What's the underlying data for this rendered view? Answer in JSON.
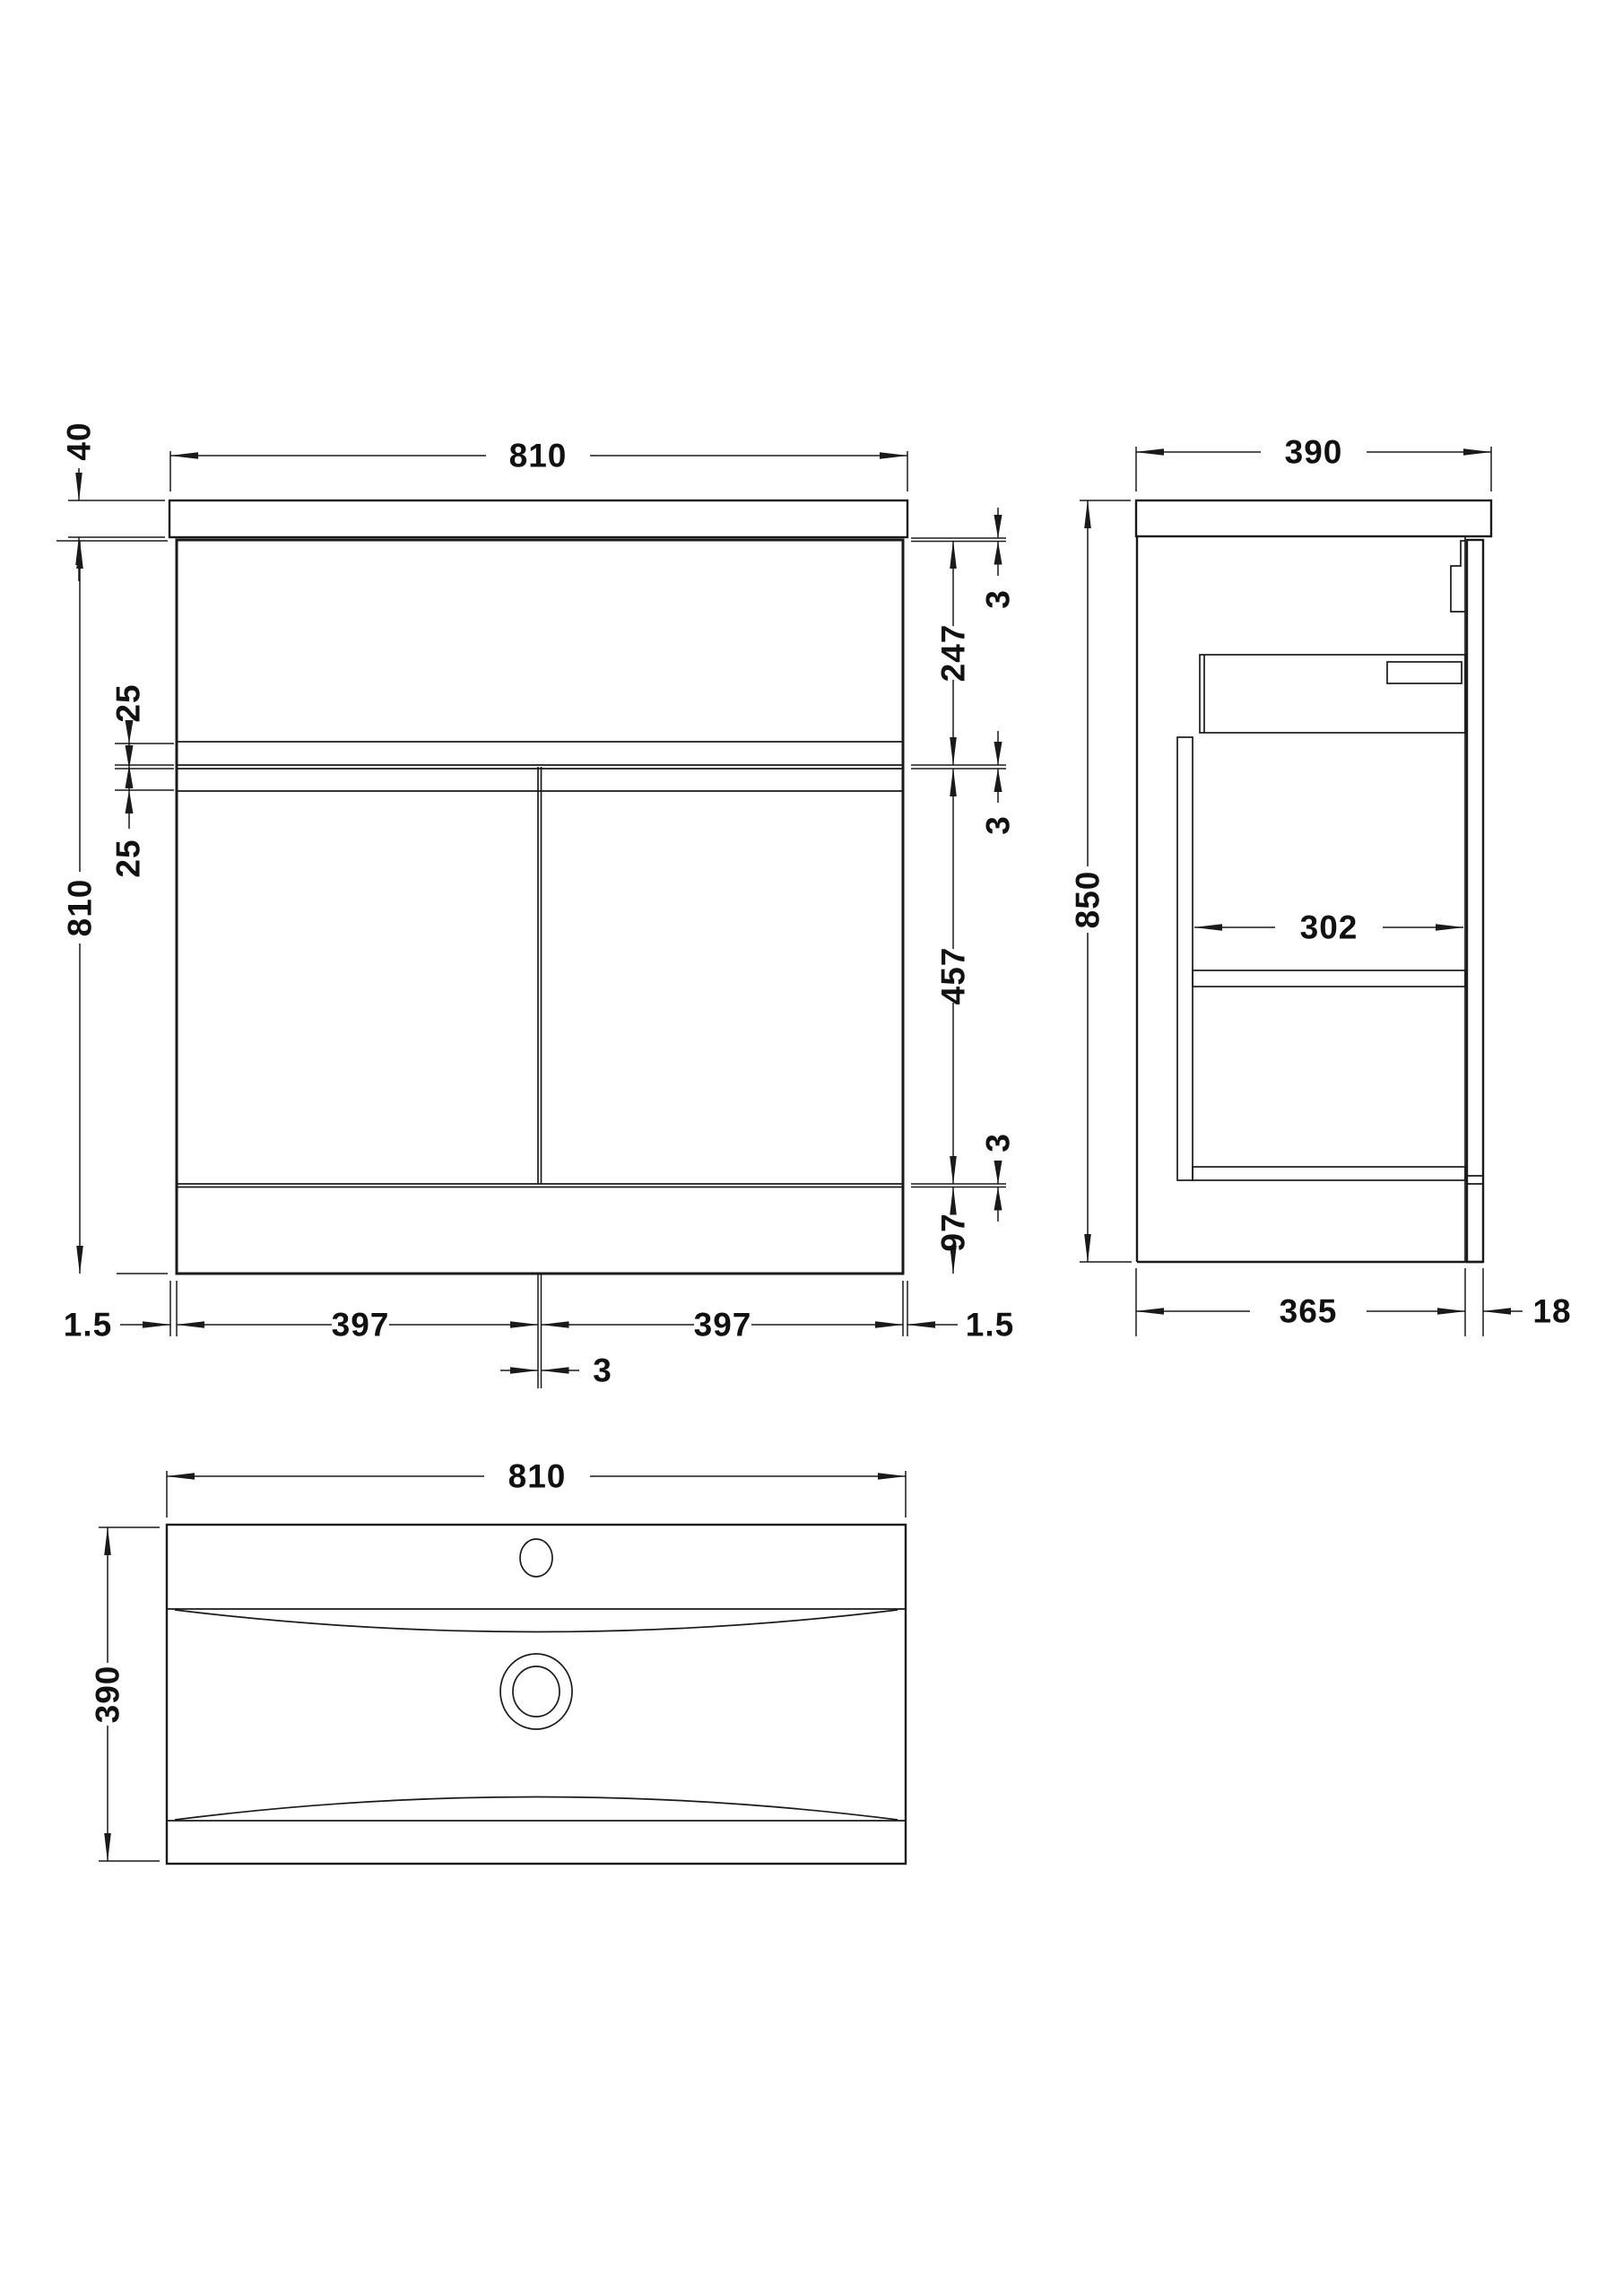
{
  "front_view": {
    "counter_width": "810",
    "counter_thickness": "40",
    "cabinet_height": "810",
    "offset_upper": "25",
    "offset_lower": "25",
    "gap_top": "3",
    "drawer_front_height": "247",
    "gap_middle": "3",
    "door_height": "457",
    "gap_lower": "3",
    "plinth_height": "97",
    "margin_left": "1.5",
    "door_width_left": "397",
    "door_gap": "3",
    "door_width_right": "397",
    "margin_right": "1.5"
  },
  "side_view": {
    "depth": "390",
    "total_height": "850",
    "internal_depth": "302",
    "carcass_depth": "365",
    "door_thickness": "18"
  },
  "plan_view": {
    "basin_width": "810",
    "basin_depth": "390"
  },
  "colors": {
    "line": "#1a1a1a",
    "background": "#ffffff"
  }
}
